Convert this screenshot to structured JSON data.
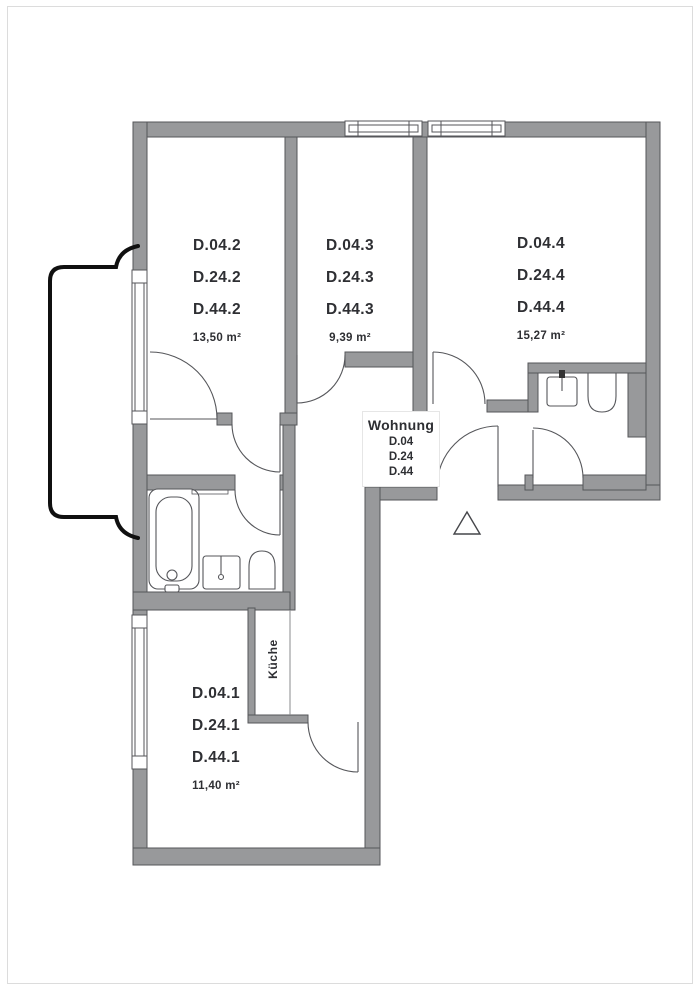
{
  "plan": {
    "apartment_block": {
      "label": "Wohnung",
      "units": [
        "D.04",
        "D.24",
        "D.44"
      ]
    },
    "rooms": [
      {
        "codes": [
          "D.04.2",
          "D.24.2",
          "D.44.2"
        ],
        "area": "13,50 m²"
      },
      {
        "codes": [
          "D.04.3",
          "D.24.3",
          "D.44.3"
        ],
        "area": "9,39 m²"
      },
      {
        "codes": [
          "D.04.4",
          "D.24.4",
          "D.44.4"
        ],
        "area": "15,27 m²"
      },
      {
        "codes": [
          "D.04.1",
          "D.24.1",
          "D.44.1"
        ],
        "area": "11,40 m²"
      }
    ],
    "kitchen_label": "Küche",
    "colors": {
      "wall_fill": "#98999b",
      "wall_edge": "#55565a",
      "line": "#55565a",
      "balcony_outline": "#101010",
      "text": "#2e2f33"
    }
  }
}
